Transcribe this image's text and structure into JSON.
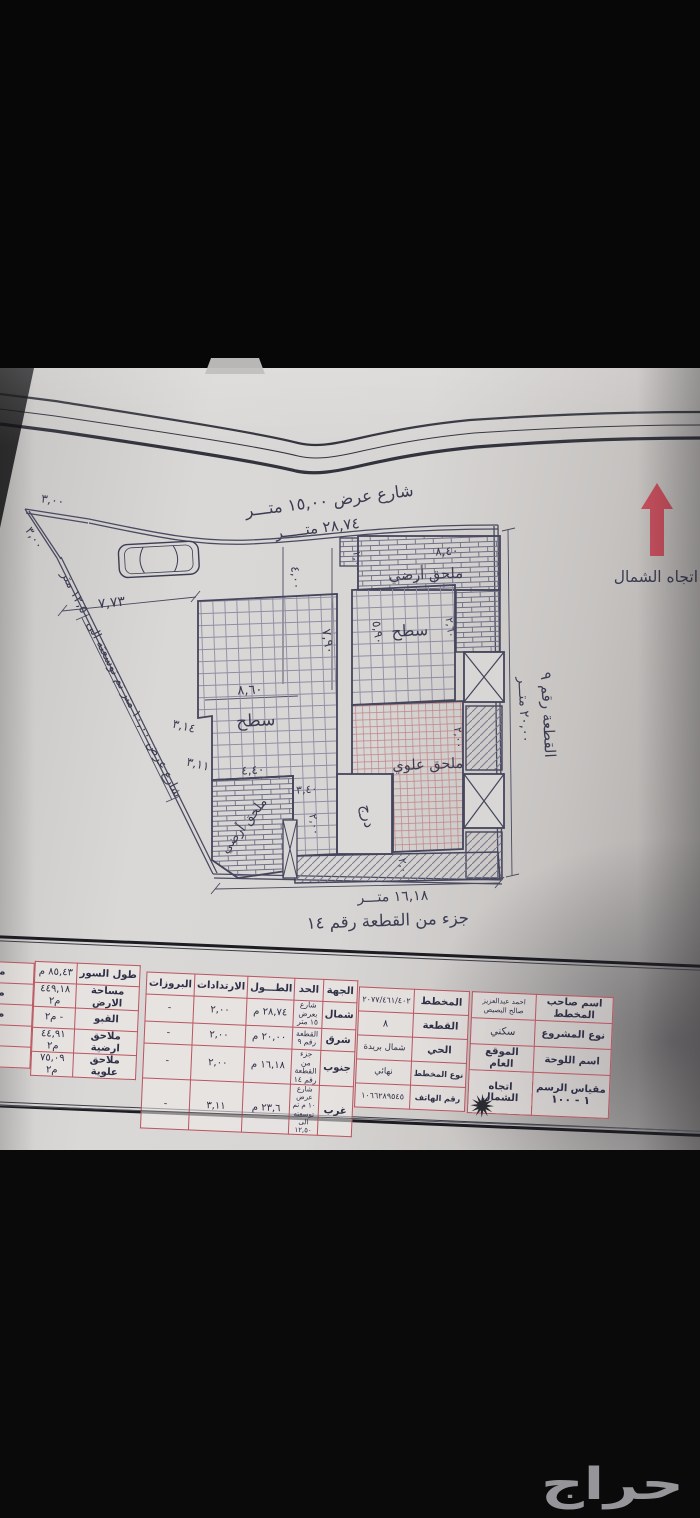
{
  "watermark": {
    "text": "حراج"
  },
  "plan": {
    "north_label": "اتجاه الشمال",
    "street_top": "شارع عرض ١٥,٠٠ متـــر",
    "street_top_len": "٢٨,٧٤ متـــــر",
    "west_street": "شارع عرض ١٠,٠٠ متر تم توسعته الى ١٢,٥٠ متر",
    "east_len": "٢٠,٠٠ متـــر",
    "east_plot": "القطعة رقم ٩",
    "south_len": "١٦,١٨ متـــر",
    "south_plot": "جزء من القطعة رقم ١٤",
    "rooms": {
      "roof_left": "سطح",
      "roof_right": "سطح",
      "upper_annex": "ملحق علوي",
      "ground_annex_top": "ملحق أرضي",
      "ground_annex_left": "ملحق أرضي",
      "stairs": "درج"
    },
    "dims": {
      "corner_a": "٣,٠٠",
      "corner_b": "٣,٠٠",
      "car": "٧,٧٣",
      "v4": "٤,٠٠",
      "v79": "٧,٩٠",
      "v2a": "٢,٠٠",
      "annex_w": "٨,٤٠",
      "roof2_h": "٥,٩٠",
      "roof2_w": "٢,٦٠",
      "roof_w": "٨,٦٠",
      "w314": "٣,١٤",
      "w311": "٣,١١",
      "ga_w": "٤,٤٠",
      "ga_a": "٣,٤٠",
      "ga_b": "٢,٠٠",
      "strip_s": "٢,٠٠",
      "strip_e": "٢,٠٠"
    }
  },
  "areas_table": {
    "rows": [
      {
        "label": "طول السور",
        "value": "٨٥,٤٣ م"
      },
      {
        "label": "مساحة الارض",
        "value": "٤٤٩,١٨ م٢"
      },
      {
        "label": "القبو",
        "value": "- م٢"
      },
      {
        "label": "ملاحق ارضية",
        "value": "٤٤,٩١ م٢"
      },
      {
        "label": "ملاحق علوية",
        "value": "٧٥,٠٩ م٢"
      }
    ],
    "edge_fragments": [
      "مسا",
      "مس",
      "مجم",
      "ملا",
      "عد"
    ]
  },
  "boundaries_table": {
    "headers": {
      "side": "الجهة",
      "limit": "الحد",
      "length": "الطـــول",
      "setbacks": "الارتدادات",
      "projections": "البروزات"
    },
    "rows": [
      {
        "side": "شمال",
        "limit": "شارع بعرض ١٥ متر",
        "length": "٢٨,٧٤ م",
        "setback": "٢,٠٠",
        "projection": "-"
      },
      {
        "side": "شرق",
        "limit": "القطعة رقم ٩",
        "length": "٢٠,٠٠ م",
        "setback": "٢,٠٠",
        "projection": "-"
      },
      {
        "side": "جنوب",
        "limit": "جزء من القطعة رقم ١٤",
        "length": "١٦,١٨ م",
        "setback": "٢,٠٠",
        "projection": "-"
      },
      {
        "side": "غرب",
        "limit": "شارع عرض ١٠ م تم توسعته الى ١٢,٥٠",
        "length": "٢٣,٦ م",
        "setback": "٣,١١",
        "projection": "-"
      }
    ]
  },
  "info_table": {
    "right_rows": [
      {
        "label": "اسم صاحب المخطط",
        "value": "احمد عبدالعزيز صالح البصيص"
      },
      {
        "label": "نوع المشروع",
        "value": "سكني"
      },
      {
        "label": "اسم اللوحة",
        "value": "الموقع العام"
      },
      {
        "label": "مقياس الرسم",
        "scale": "١ - ١٠٠",
        "value": "اتجاه الشمال"
      }
    ],
    "left_rows": [
      {
        "label": "المخطط",
        "value": "٢٠٧٧/٤٦١/٤٠٢"
      },
      {
        "label": "القطعة",
        "value": "٨"
      },
      {
        "label": "الحي",
        "value": "شمال بريدة"
      },
      {
        "label": "نوع المخطط",
        "value": "نهائي"
      },
      {
        "label": "رقم الهاتف",
        "value": "١٠٦٦٢٨٩٥٤٥"
      }
    ]
  },
  "colors": {
    "north_arrow": "#c7505e",
    "table_line": "#bb5560",
    "ink": "#3c3c52"
  }
}
